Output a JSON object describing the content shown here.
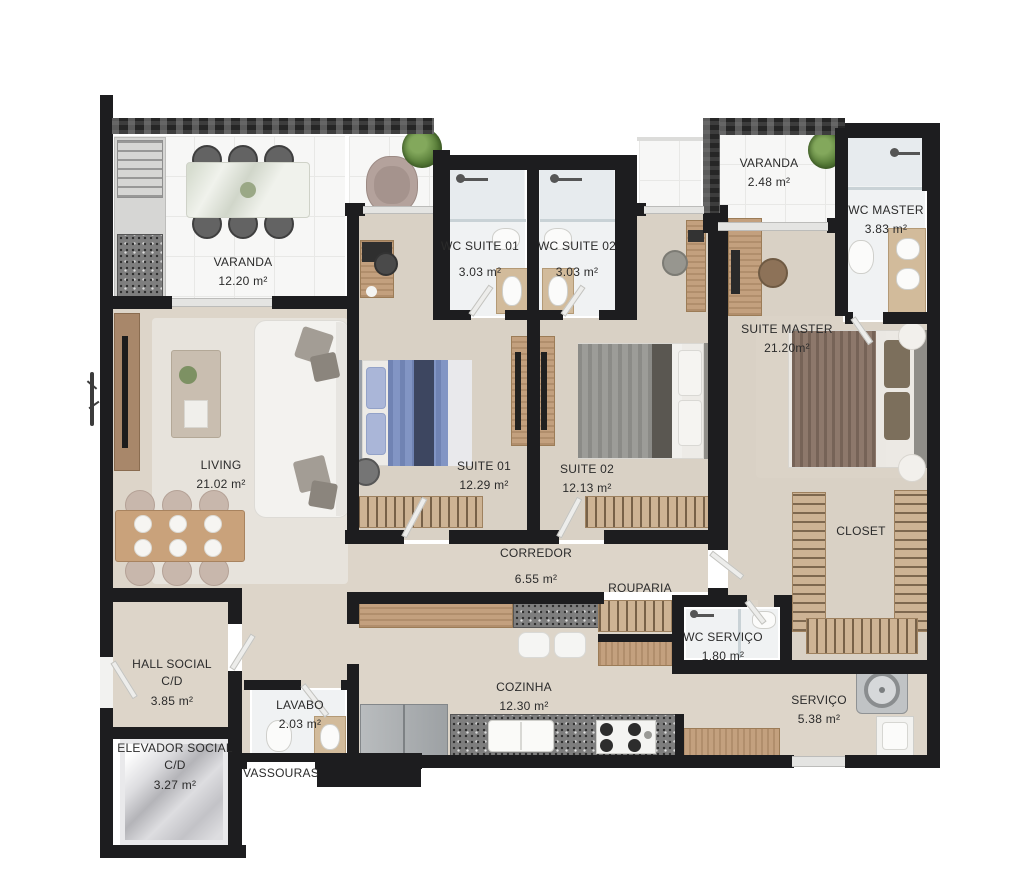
{
  "plan_title": "Apartment floor plan",
  "colors": {
    "wall": "#1d1d1f",
    "floor_beige": "#ddd5c9",
    "floor_tile": "#f7f7f6",
    "floor_wc": "#f0f2f3",
    "wood": "#c3a07e",
    "granite": "#7e7e7e",
    "label_text": "#2b2b2b",
    "bed_blue": "#8295c4",
    "bed_gray": "#9c9c98",
    "bed_brown": "#8d786b",
    "plant_green": "#567b37"
  },
  "rooms": {
    "varanda_main": {
      "name": "VARANDA",
      "area": "12.20 m²"
    },
    "wc_suite_01": {
      "name": "WC SUITE 01",
      "area": "3.03 m²"
    },
    "wc_suite_02": {
      "name": "WC SUITE 02",
      "area": "3.03 m²"
    },
    "varanda_master": {
      "name": "VARANDA",
      "area": "2.48 m²"
    },
    "wc_master": {
      "name": "WC MASTER",
      "area": "3.83 m²"
    },
    "suite_master": {
      "name": "SUITE MASTER",
      "area": "21.20m²"
    },
    "living": {
      "name": "LIVING",
      "area": "21.02 m²"
    },
    "suite_01": {
      "name": "SUITE 01",
      "area": "12.29 m²"
    },
    "suite_02": {
      "name": "SUITE 02",
      "area": "12.13 m²"
    },
    "corredor": {
      "name": "CORREDOR",
      "area": "6.55 m²"
    },
    "rouparia": {
      "name": "ROUPARIA",
      "area": ""
    },
    "closet": {
      "name": "CLOSET",
      "area": ""
    },
    "wc_servico": {
      "name": "WC SERVIÇO",
      "area": "1.80 m²"
    },
    "hall_social": {
      "name": "HALL SOCIAL",
      "sub": "C/D",
      "area": "3.85 m²"
    },
    "lavabo": {
      "name": "LAVABO",
      "area": "2.03 m²"
    },
    "cozinha": {
      "name": "COZINHA",
      "area": "12.30 m²"
    },
    "servico": {
      "name": "SERVIÇO",
      "area": "5.38 m²"
    },
    "elevador_social": {
      "name": "ELEVADOR SOCIAL",
      "sub": "C/D",
      "area": "3.27 m²"
    },
    "vassouras": {
      "name": "VASSOURAS",
      "area": ""
    }
  }
}
